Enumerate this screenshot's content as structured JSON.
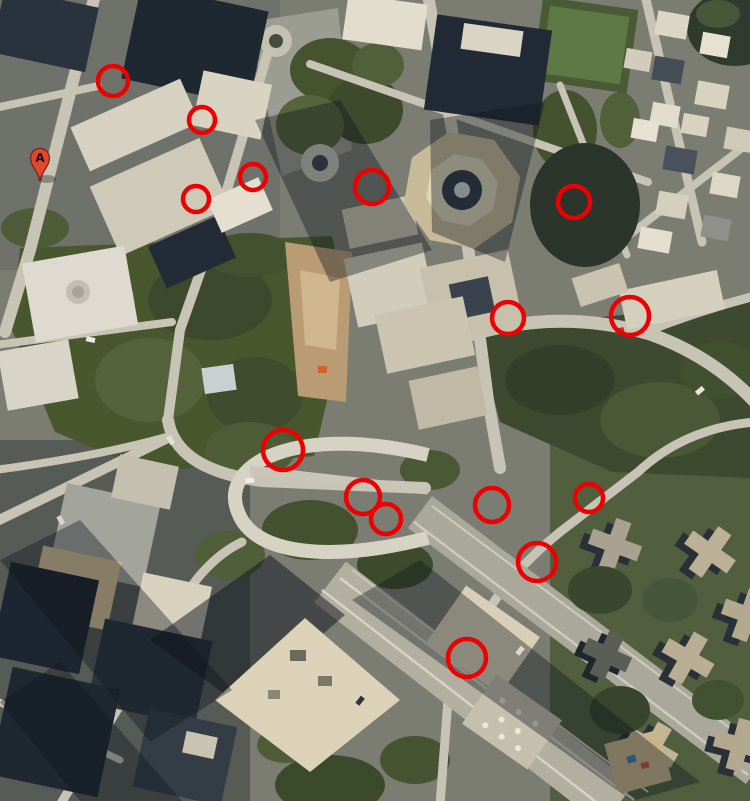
{
  "page": {
    "kind": "satellite-map-screenshot",
    "width_px": 750,
    "height_px": 801
  },
  "map": {
    "view_mode": "satellite",
    "marker": {
      "label": "A",
      "x": 40,
      "y": 158,
      "pin_color": "#e0482e",
      "pin_border_color": "#7e1f12",
      "letter_color": "#1a120c"
    },
    "annotations": {
      "shape": "circle",
      "color": "#ee0000",
      "stroke_width": 4.5,
      "circles": [
        {
          "id": 1,
          "x": 113,
          "y": 81,
          "r": 15
        },
        {
          "id": 2,
          "x": 202,
          "y": 120,
          "r": 13
        },
        {
          "id": 3,
          "x": 196,
          "y": 199,
          "r": 13
        },
        {
          "id": 4,
          "x": 253,
          "y": 177,
          "r": 13
        },
        {
          "id": 5,
          "x": 372,
          "y": 187,
          "r": 17
        },
        {
          "id": 6,
          "x": 574,
          "y": 202,
          "r": 16
        },
        {
          "id": 7,
          "x": 508,
          "y": 318,
          "r": 16
        },
        {
          "id": 8,
          "x": 630,
          "y": 316,
          "r": 19
        },
        {
          "id": 9,
          "x": 283,
          "y": 450,
          "r": 20
        },
        {
          "id": 10,
          "x": 363,
          "y": 497,
          "r": 17
        },
        {
          "id": 11,
          "x": 386,
          "y": 519,
          "r": 15
        },
        {
          "id": 12,
          "x": 492,
          "y": 505,
          "r": 17
        },
        {
          "id": 13,
          "x": 589,
          "y": 498,
          "r": 14
        },
        {
          "id": 14,
          "x": 537,
          "y": 562,
          "r": 19
        },
        {
          "id": 15,
          "x": 467,
          "y": 658,
          "r": 19
        }
      ]
    },
    "palette": {
      "ground": "#7b7d72",
      "road": "#c7c4b5",
      "building_dark": "#242c37",
      "building_light": "#ddd7c4",
      "park_green": "#49572f",
      "construction_tan": "#b99b74"
    }
  }
}
